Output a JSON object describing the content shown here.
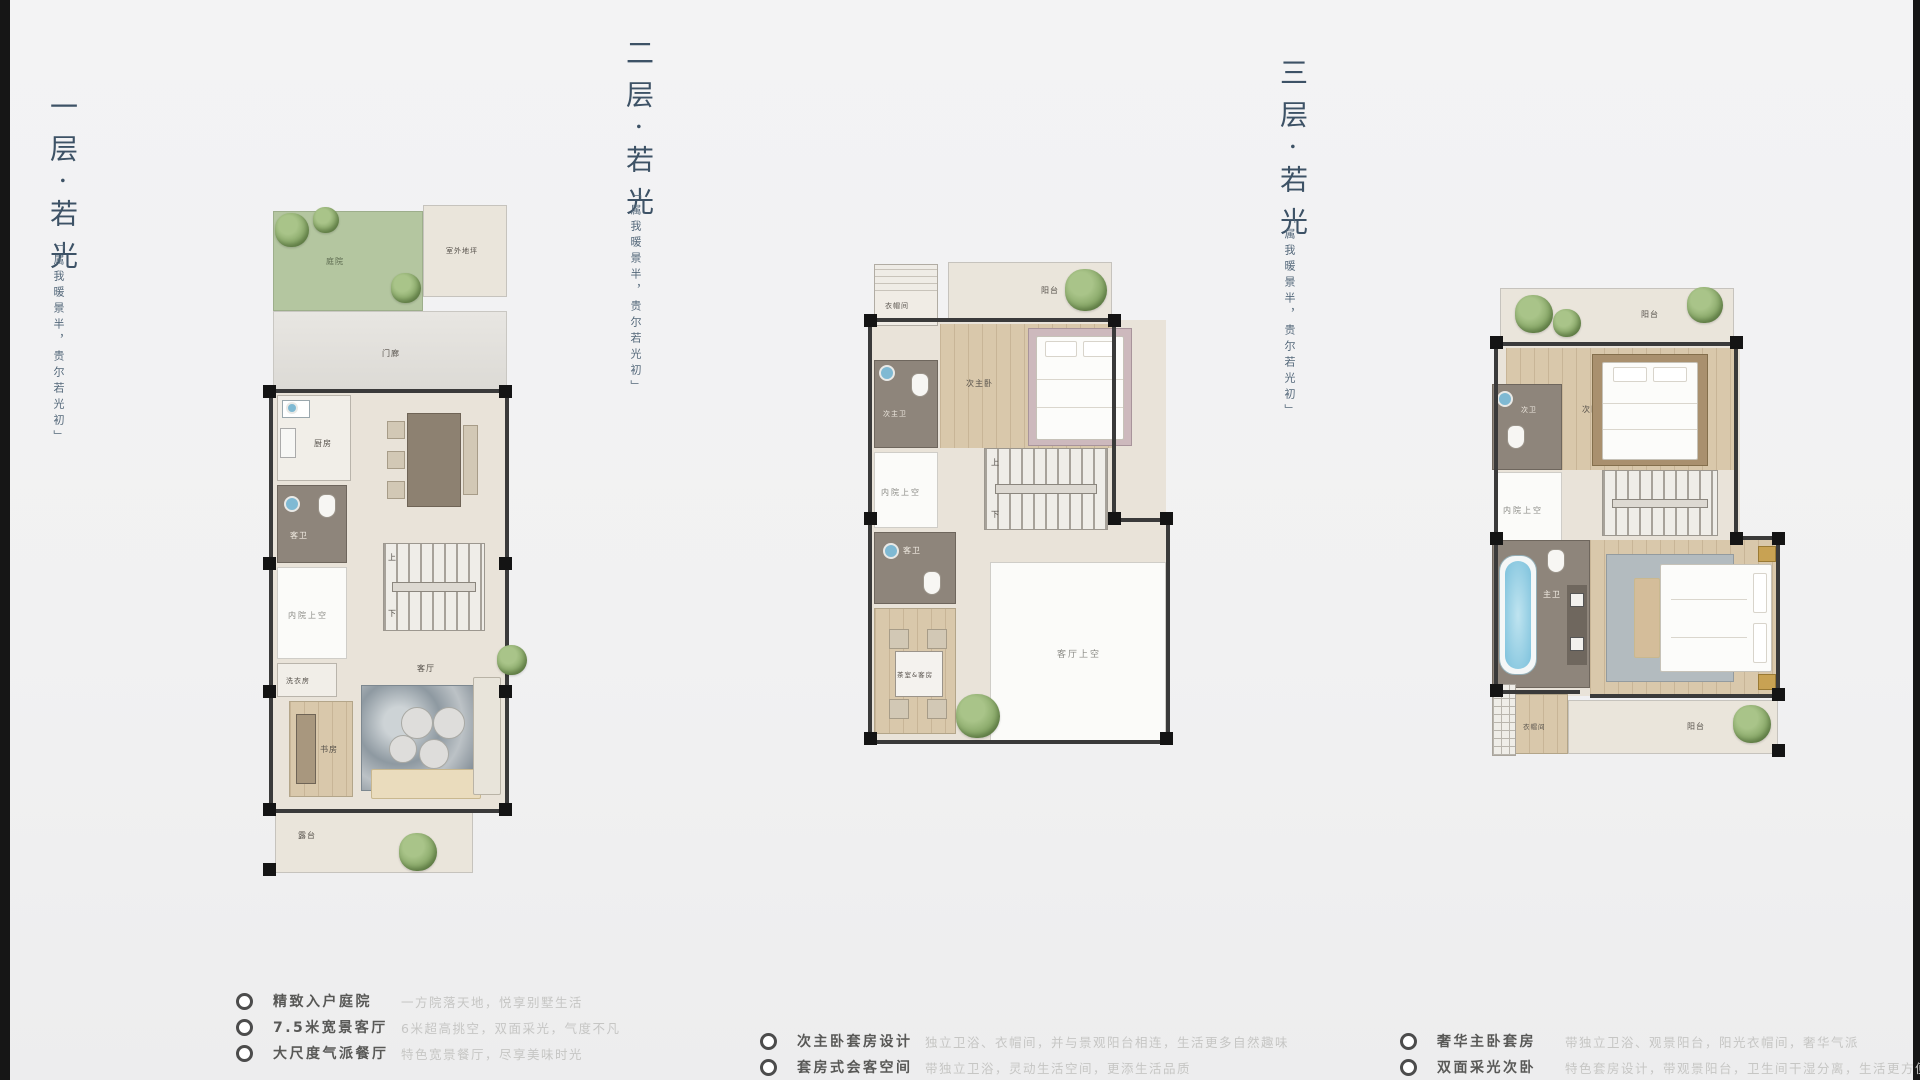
{
  "floors": [
    {
      "title": "一层·若光",
      "subtitle": "「属我暖景半，贵尔若光初」",
      "stair_up": "上",
      "stair_down": "下",
      "rooms": {
        "garden": "庭院",
        "outdoor_slab": "室外地坪",
        "porch": "门廊",
        "kitchen": "厨房",
        "dining": "餐厅",
        "guest_bath": "客卫",
        "courtyard_void": "内院上空",
        "laundry": "洗衣房",
        "study": "书房",
        "living": "客厅",
        "terrace": "露台"
      },
      "features": [
        {
          "label": "精致入户庭院",
          "desc": "一方院落天地，悦享别墅生活"
        },
        {
          "label": "7.5米宽景客厅",
          "desc": "6米超高挑空，双面采光，气度不凡"
        },
        {
          "label": "大尺度气派餐厅",
          "desc": "特色宽景餐厅，尽享美味时光"
        }
      ]
    },
    {
      "title": "二层·若光",
      "subtitle": "「属我暖景半，贵尔若光初」",
      "stair_up": "上",
      "stair_down": "下",
      "rooms": {
        "closet": "衣帽间",
        "balcony": "阳台",
        "jr_master": "次主卧",
        "jr_master_bath": "次主卫",
        "courtyard_void": "内院上空",
        "guest_bath": "客卫",
        "tea_guest": "茶室&客房",
        "living_void": "客厅上空"
      },
      "features": [
        {
          "label": "次主卧套房设计",
          "desc": "独立卫浴、衣帽间，并与景观阳台相连，生活更多自然趣味"
        },
        {
          "label": "套房式会客空间",
          "desc": "带独立卫浴，灵动生活空间，更添生活品质"
        }
      ]
    },
    {
      "title": "三层·若光",
      "subtitle": "「属我暖景半，贵尔若光初」",
      "rooms": {
        "balcony_top": "阳台",
        "bedroom2": "次卧",
        "bath2": "次卫",
        "courtyard_void": "内院上空",
        "master_bath": "主卫",
        "master_bedroom": "主卧室",
        "closet": "衣帽间",
        "balcony_bottom": "阳台"
      },
      "features": [
        {
          "label": "奢华主卧套房",
          "desc": "带独立卫浴、观景阳台，阳光衣帽间，奢华气派"
        },
        {
          "label": "双面采光次卧",
          "desc": "特色套房设计，带观景阳台，卫生间干湿分离，生活更方便"
        }
      ]
    }
  ]
}
